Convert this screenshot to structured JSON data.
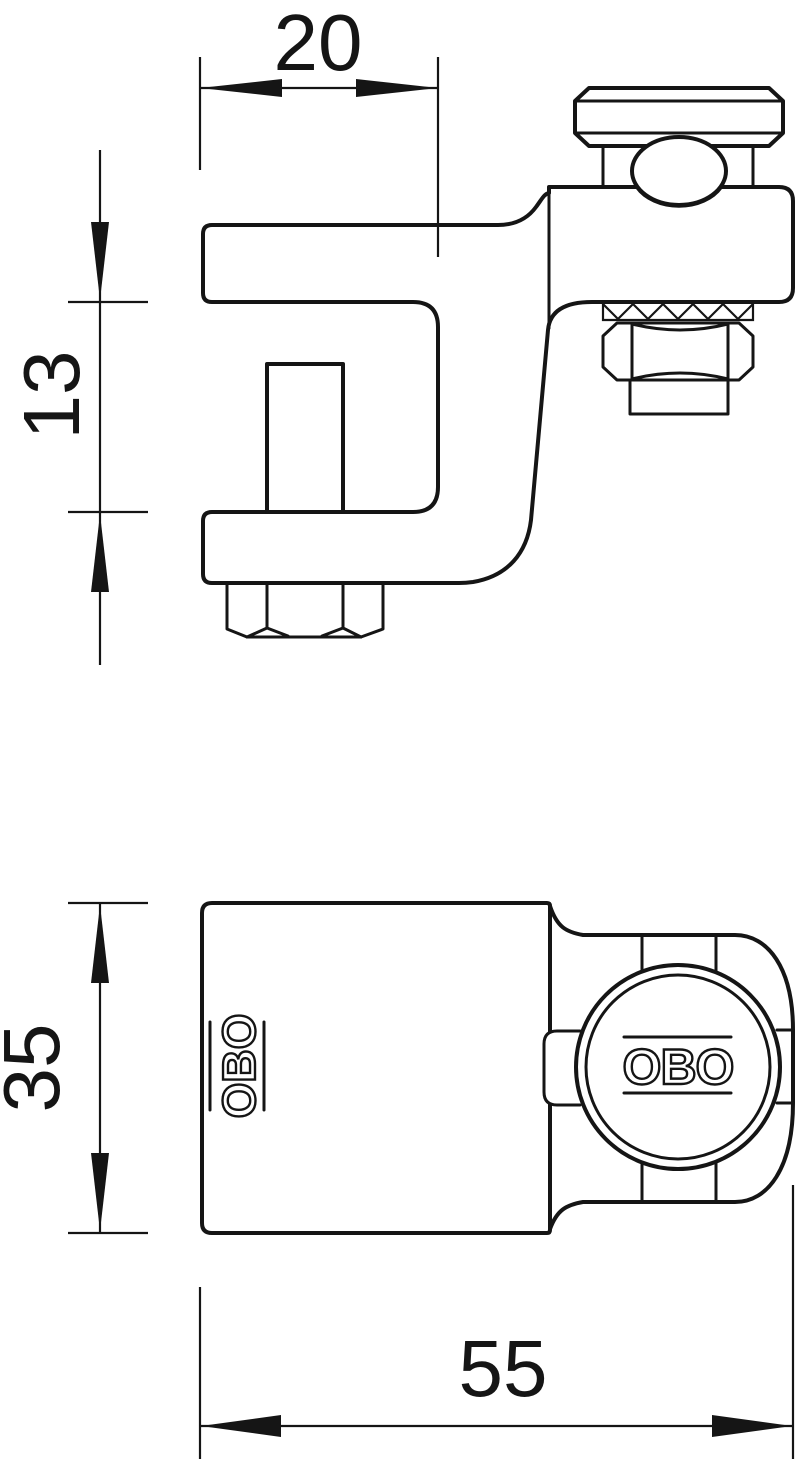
{
  "page": {
    "background": "#ffffff",
    "line_color": "#151515",
    "description": "Technical dimension drawing of a beam clamp in two views"
  },
  "dims": {
    "d20": "20",
    "d13": "13",
    "d35": "35",
    "d55": "55"
  },
  "logos": {
    "body_logo": "OBO",
    "knob_logo": "OBO"
  }
}
